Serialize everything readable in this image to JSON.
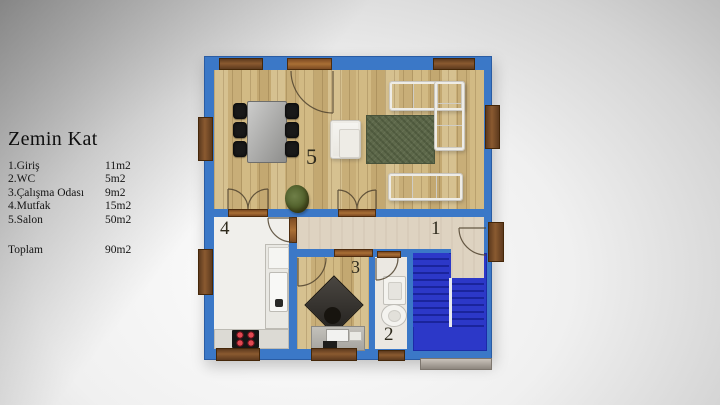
{
  "legend": {
    "title": "Zemin Kat",
    "rows": [
      {
        "label": "1.Giriş",
        "value": "11m2"
      },
      {
        "label": "2.WC",
        "value": "5m2"
      },
      {
        "label": "3.Çalışma Odası",
        "value": "9m2"
      },
      {
        "label": "4.Mutfak",
        "value": "15m2"
      },
      {
        "label": "5.Salon",
        "value": "50m2"
      }
    ],
    "total": {
      "label": "Toplam",
      "value": "90m2"
    }
  },
  "floorplan": {
    "floor_name": "Zemin Kat",
    "rooms": [
      {
        "number": "1",
        "name": "Giriş",
        "area": "11m2"
      },
      {
        "number": "2",
        "name": "WC",
        "area": "5m2"
      },
      {
        "number": "3",
        "name": "Çalışma Odası",
        "area": "9m2"
      },
      {
        "number": "4",
        "name": "Mutfak",
        "area": "15m2"
      },
      {
        "number": "5",
        "name": "Salon",
        "area": "50m2"
      }
    ],
    "total_area": "90m2",
    "colors": {
      "wall_blue": "#3b78c7",
      "stair_blue": "#2c38c8",
      "wood_floor": "#d0b57f",
      "hall_floor": "#ded3c1",
      "kitchen_floor": "#f0efeb",
      "wc_floor": "#ebe8e2",
      "rug_green": "#5d684a",
      "window_frame": "#744824",
      "sofa_white": "#f3f2ee"
    }
  }
}
